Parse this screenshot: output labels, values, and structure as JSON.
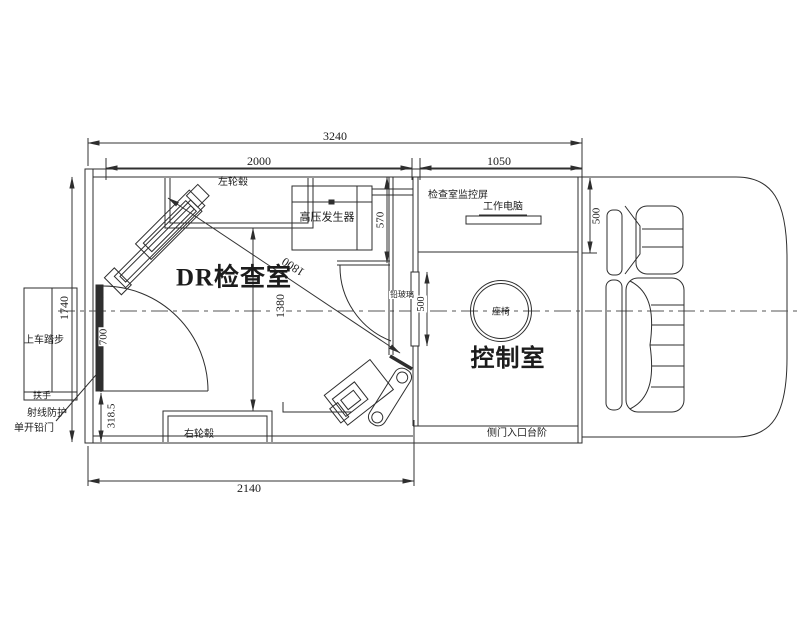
{
  "drawing": {
    "type": "vehicle-floor-plan",
    "rooms": {
      "exam_room": "DR检查室",
      "control_room": "控制室"
    },
    "labels": {
      "left_wheel": "左轮毂",
      "right_wheel": "右轮毂",
      "hv_generator": "高压发生器",
      "monitor_screen": "检查室监控屏",
      "work_computer": "工作电脑",
      "lead_glass": "铅玻璃",
      "operator_seat": "座椅",
      "boarding_steps": "上车踏步",
      "handrail": "扶手",
      "shield_door_line1": "射线防护",
      "shield_door_line2": "单开铅门",
      "side_entrance_step": "侧门入口台阶"
    },
    "dims": {
      "overall_length": "3240",
      "exam_room_length": "2000",
      "control_room_length": "1050",
      "interior_width": "1740",
      "door_width": "700",
      "door_to_rear": "318.5",
      "bottom_span": "2140",
      "wheel_gap": "1380",
      "generator_depth": "570",
      "window_height": "500",
      "console_depth": "500",
      "sid_diagonal": "1800"
    },
    "colors": {
      "line": "#2e2e2e",
      "text": "#1c1c1c",
      "background": "#ffffff"
    }
  }
}
